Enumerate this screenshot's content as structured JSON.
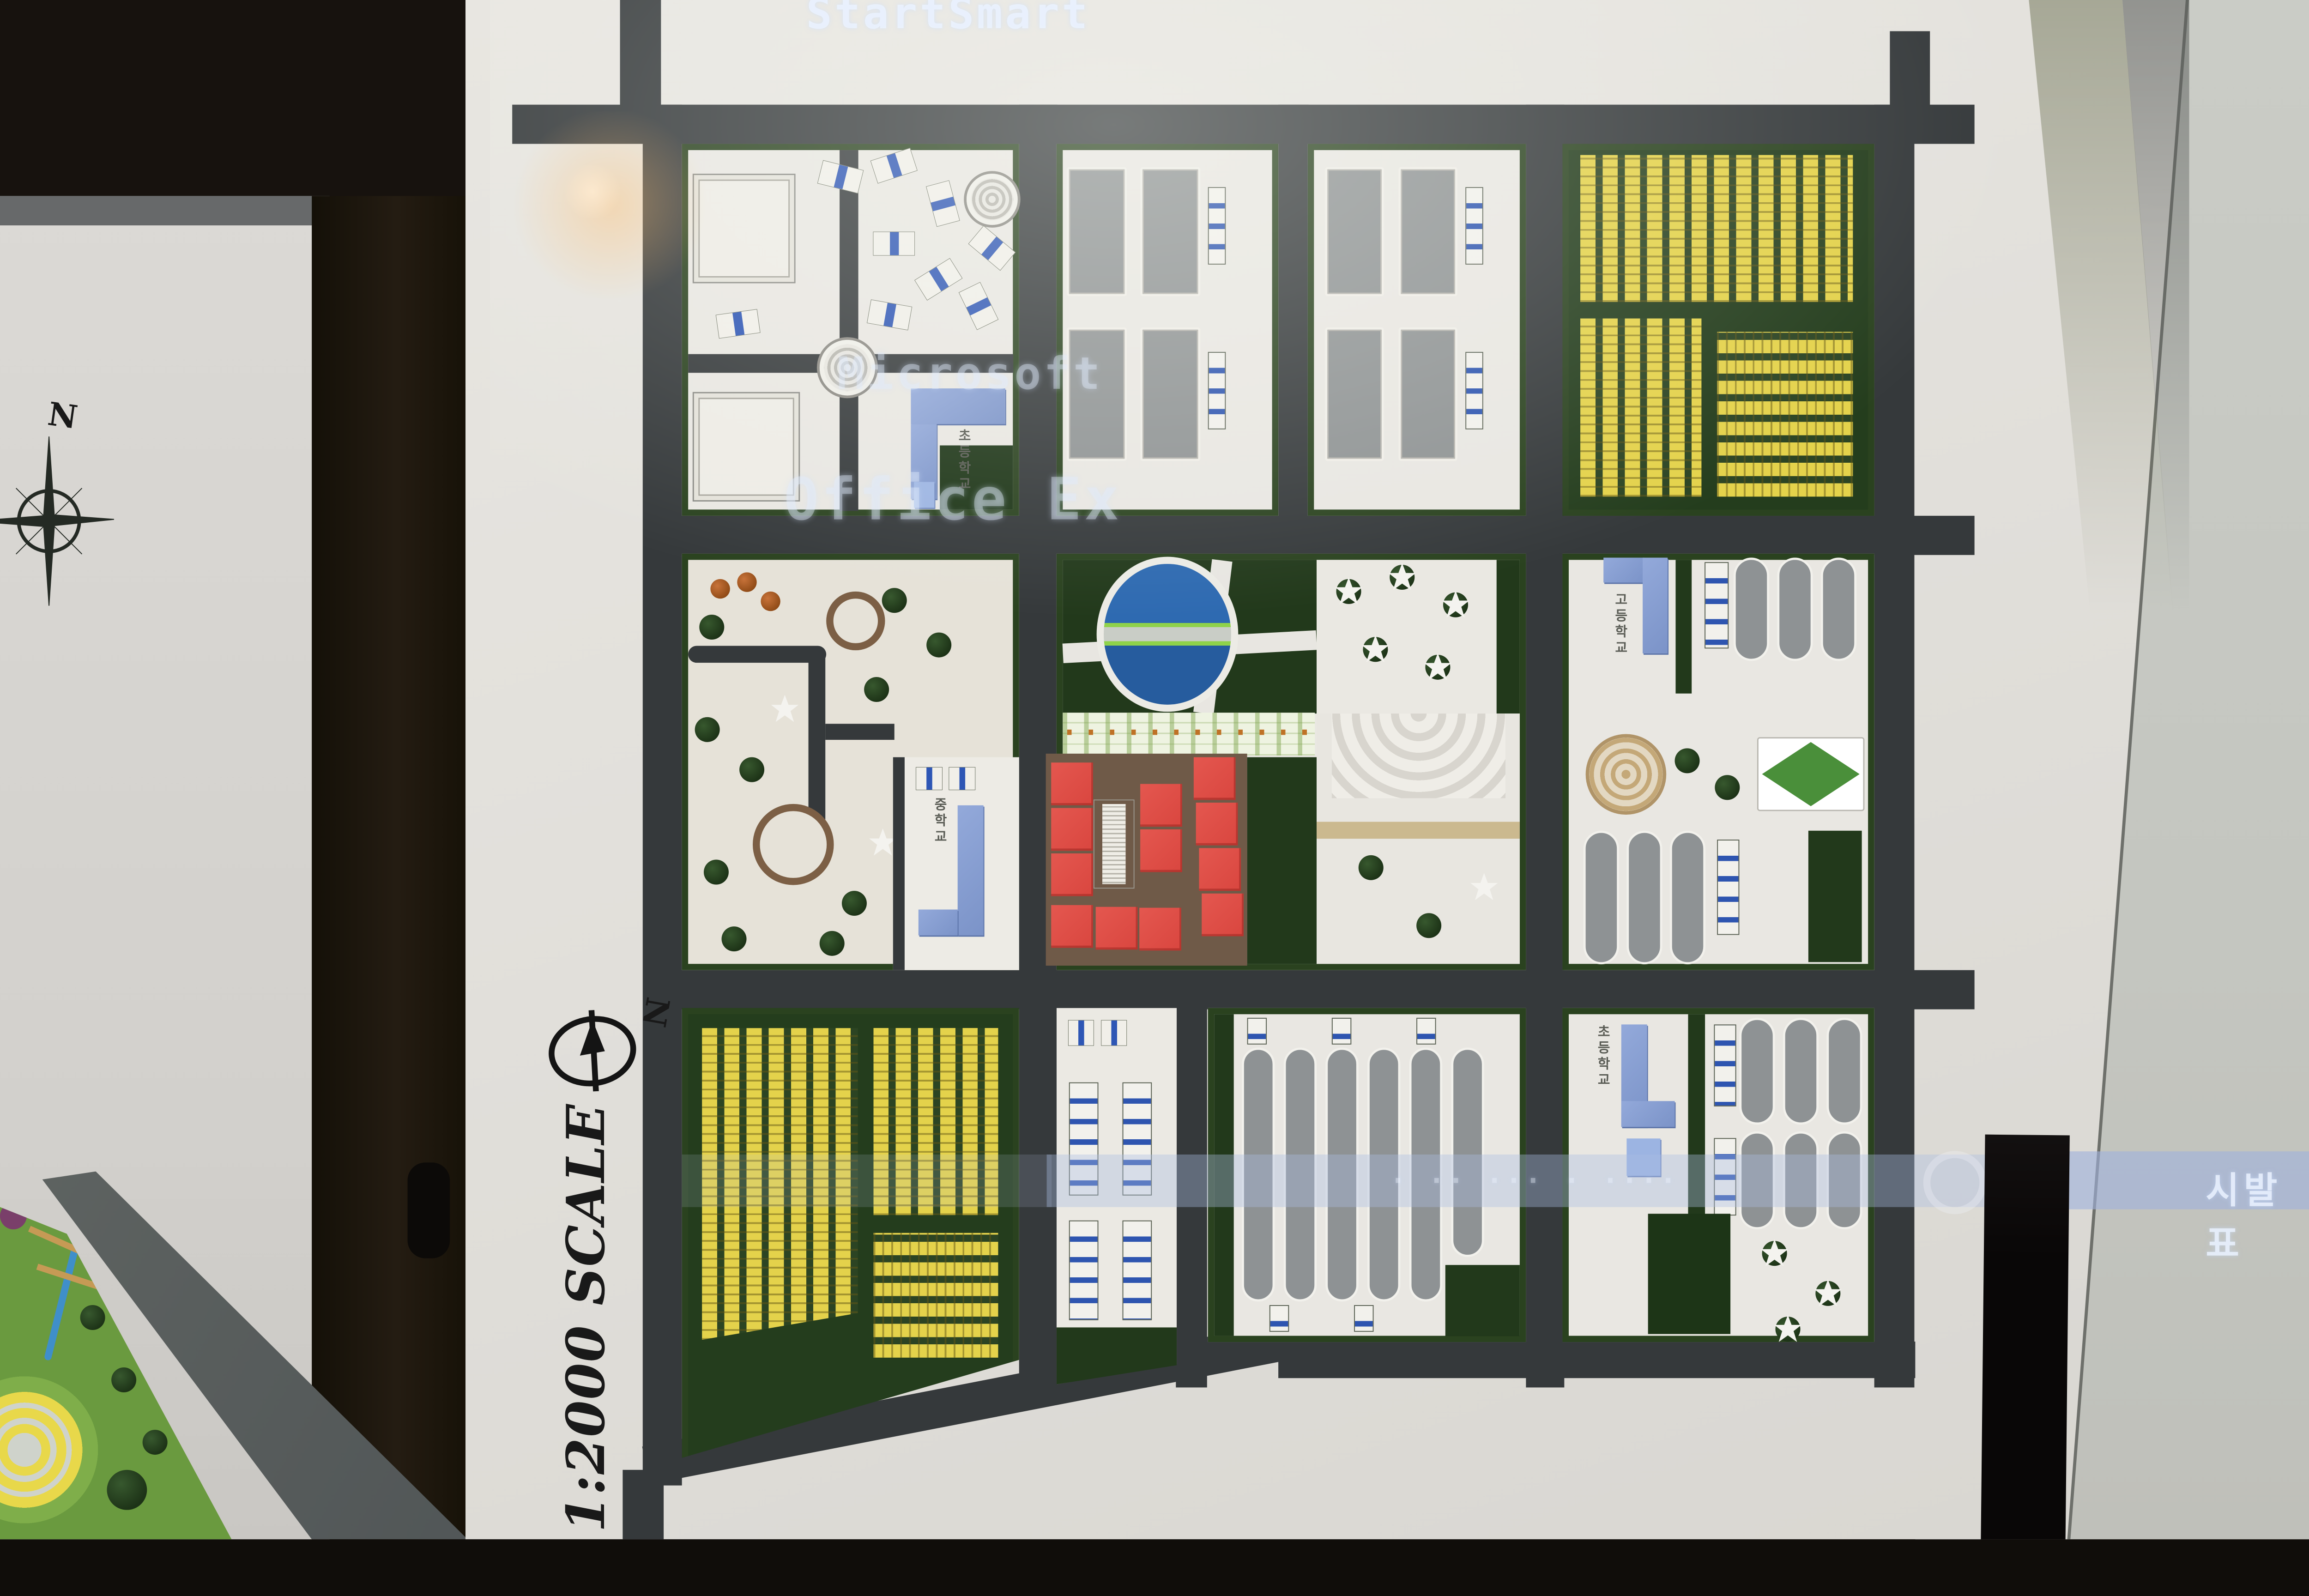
{
  "scene": {
    "projection": {
      "screen_title": "StartSmart",
      "projected_word_1": "Microsoft",
      "projected_word_2": "Office Ex",
      "ticker_right": "시발표",
      "ticker_faint": "· ·· ··· · ····"
    },
    "left_board": {
      "compass_label": "N"
    },
    "model_board": {
      "north_label": "N",
      "scale_label": "1:2000 SCALE",
      "labels": {
        "elementary_school_nw": "초등학교",
        "middle_school_w": "중학교",
        "high_school_e": "고등학교",
        "elementary_school_se": "초등학교"
      },
      "colors": {
        "road": "#35393b",
        "board": "#e2e0db",
        "hedge_green": "#2a421f",
        "housing_yellow": "#e4d24b",
        "industrial_gray": "#8f9394",
        "school_blue": "#8ba2d4",
        "apartment_red": "#df4f48",
        "pond_blue": "#2e6ab1"
      }
    }
  }
}
